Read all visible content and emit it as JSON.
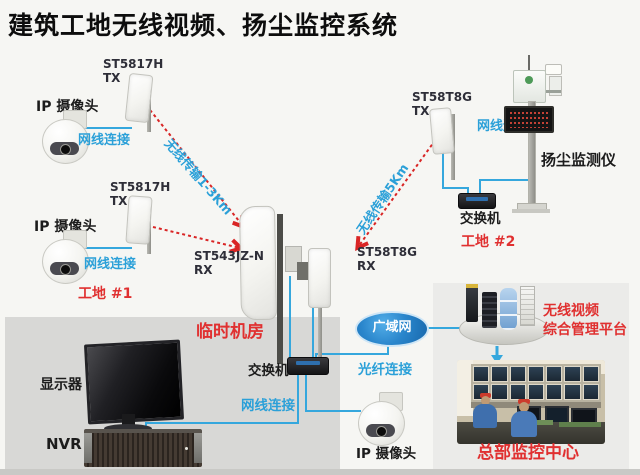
{
  "title": "建筑工地无线视频、扬尘监控系统",
  "labels": {
    "camera": "IP 摄像头",
    "cable": "网线连接",
    "fiber": "光纤连接",
    "switch": "交换机",
    "monitor": "显示器",
    "nvr": "NVR",
    "dust_monitor": "扬尘监测仪",
    "room": "临时机房",
    "wan": "广域网",
    "site1": "工地 #1",
    "site2": "工地 #2",
    "hq_center": "总部监控中心",
    "platform_line1": "无线视频",
    "platform_line2": "综合管理平台",
    "link_1_3km": "无线传输1-3Km",
    "link_5km": "无线传输5Km"
  },
  "devices": {
    "tx1": "ST5817H\nTX",
    "tx2": "ST5817H\nTX",
    "tx3": "ST58T8G\nTX",
    "rx1": "ST543JZ-N\nRX",
    "rx2": "ST58T8G\nRX"
  },
  "colors": {
    "accent_blue": "#2BA0D8",
    "line_blue": "#35A7DD",
    "dashed_red": "#D92525",
    "label_red": "#E03030",
    "wan_blue": "#1B72C0",
    "room_gray": "#D8D8D6",
    "hq_gray": "#EBEBE9"
  }
}
